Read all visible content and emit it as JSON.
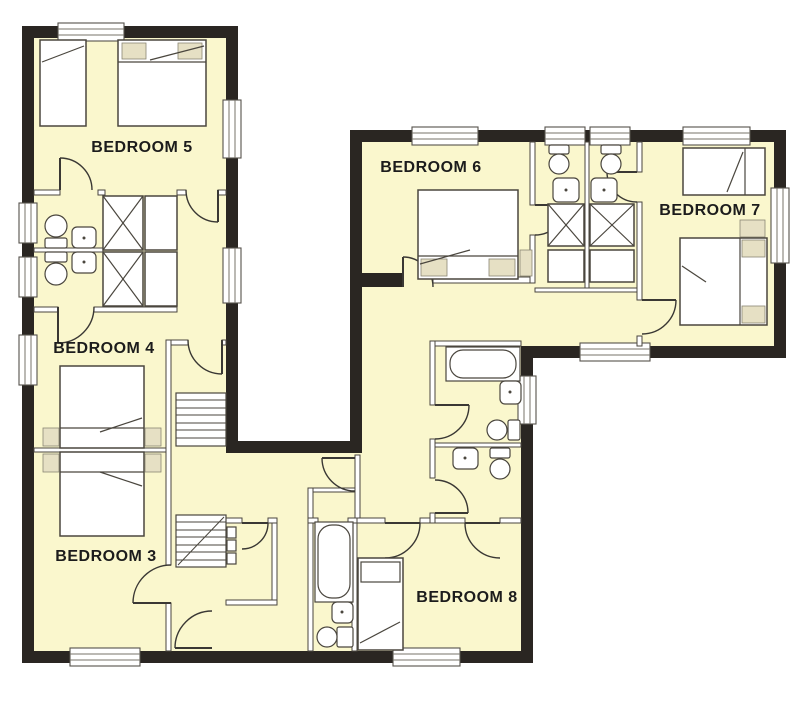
{
  "plan": {
    "type": "floor-plan",
    "rooms": [
      {
        "id": "bedroom-5",
        "label": "BEDROOM 5"
      },
      {
        "id": "bedroom-4",
        "label": "BEDROOM 4"
      },
      {
        "id": "bedroom-3",
        "label": "BEDROOM 3"
      },
      {
        "id": "bedroom-6",
        "label": "BEDROOM 6"
      },
      {
        "id": "bedroom-7",
        "label": "BEDROOM 7"
      },
      {
        "id": "bedroom-8",
        "label": "BEDROOM 8"
      }
    ],
    "fixtures": {
      "beds": 8,
      "toilets": 7,
      "sinks": 7,
      "bathtubs": 2,
      "wardrobes": 6,
      "staircase_flights": 2,
      "windows": 14,
      "doors": 16
    },
    "colors": {
      "wall": "#2a2622",
      "floor": "#faf7cd",
      "outline": "#4a463e",
      "window": "#ffffff",
      "furniture_accent": "#e6e0c4",
      "label_text": "#1c1c1c",
      "background": "#ffffff"
    }
  }
}
